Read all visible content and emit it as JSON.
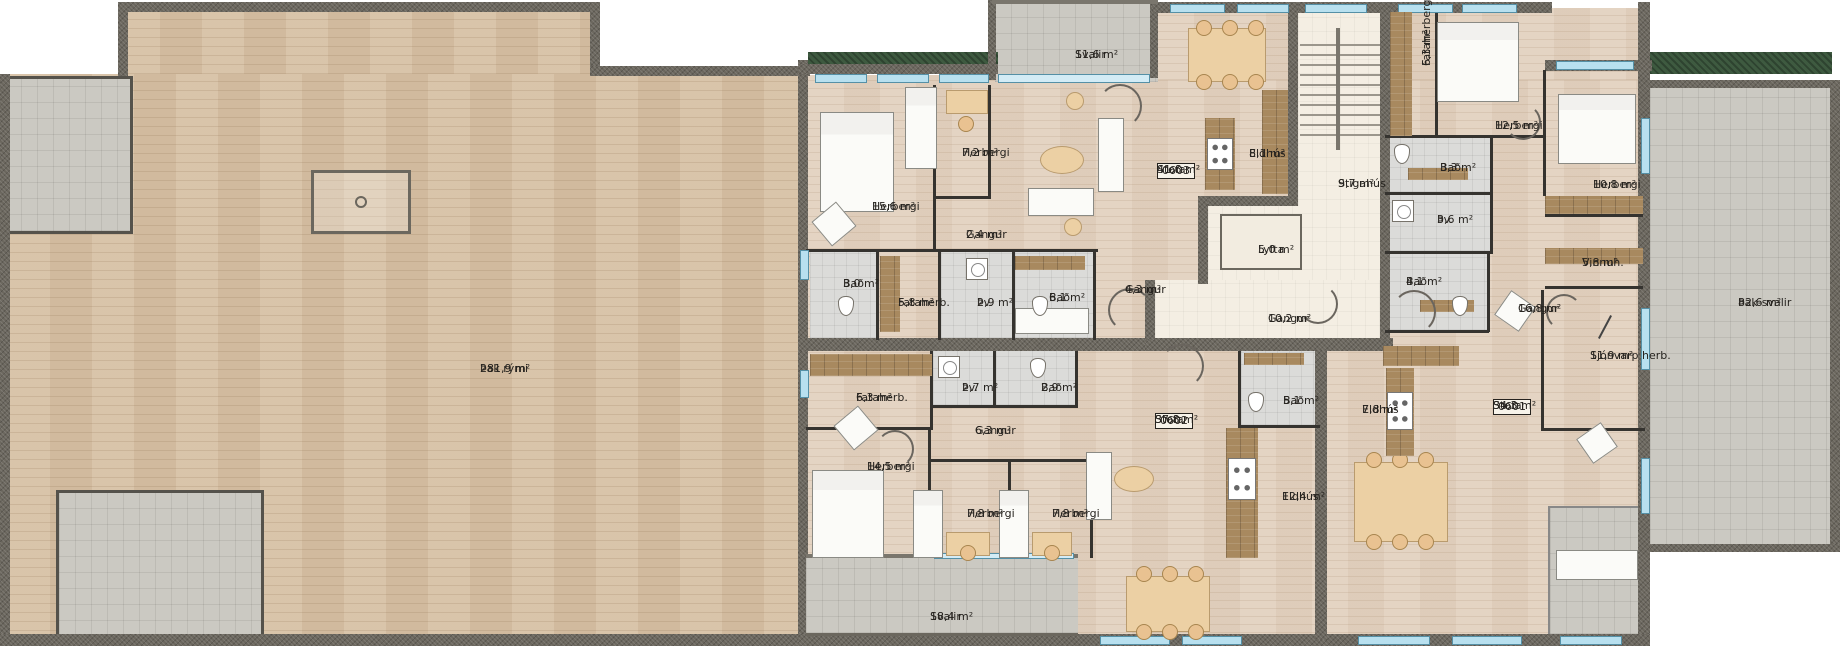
{
  "palette": {
    "wall": "#6b675e",
    "wood-attic": "#d7c1a5",
    "wood-apt": "#e3d2c0",
    "tile-bath": "#dbdbd9",
    "tile-balcony": "#cbc9c2",
    "cream": "#f4eee3",
    "green-roof": "#3e5a40",
    "window-blue": "#b8e0ef",
    "label-ink": "#26231f"
  },
  "rooms": {
    "thak_rymi": {
      "name": "Þak rými",
      "area": "281,9 m²"
    },
    "svalir_0603": {
      "name": "Svalir",
      "area": "11,6 m²"
    },
    "herbergi_15_6": {
      "name": "Herbergi",
      "area": "15,6 m²"
    },
    "herbergi_7_2": {
      "name": "Herbergi",
      "area": "7,2 m²"
    },
    "gangur_2_4": {
      "name": "Gangur",
      "area": "2,4 m²"
    },
    "bad_3_0": {
      "name": "Bað",
      "area": "3,0 m²"
    },
    "fataherb_5_8": {
      "name": "Fataherb.",
      "area": "5,8 m²"
    },
    "thv_2_9": {
      "name": "Þv.",
      "area": "2,9 m²"
    },
    "bad_6_1": {
      "name": "Bað",
      "area": "6,1 m²"
    },
    "gangur_4_3": {
      "name": "Gangur",
      "area": "4,3 m²"
    },
    "stofa_0603": {
      "badge": "0603",
      "name": "Stofa",
      "area": "41,6 m²"
    },
    "eldhus_8_1": {
      "name": "Eldhús",
      "area": "8,1 m²"
    },
    "stigahus": {
      "name": "Stigahús",
      "area": "9,7 m²"
    },
    "lyfta": {
      "name": "Lyfta",
      "area": "5,0 m²"
    },
    "gangur_10_2": {
      "name": "Gangur",
      "area": "10,2 m²"
    },
    "fataherbergi_6_3": {
      "name": "Fataherbergi",
      "area": "6,3 m²"
    },
    "herbergi_12_5": {
      "name": "Herbergi",
      "area": "12,5 m²"
    },
    "bad_3_3": {
      "name": "Bað",
      "area": "3,3 m²"
    },
    "thv_3_6": {
      "name": "Þv.",
      "area": "3,6 m²"
    },
    "bad_4_1": {
      "name": "Bað",
      "area": "4,1 m²"
    },
    "herbergi_10_8": {
      "name": "Herbergi",
      "area": "10,8 m²"
    },
    "vinnuh_5_8": {
      "name": "Vinnuh.",
      "area": "5,8 m²"
    },
    "gangur_16_8": {
      "name": "Gangur",
      "area": "16,8 m²"
    },
    "sjonvarp_herb": {
      "name": "Sjónvarp herb.",
      "area": "11,9 m²"
    },
    "stofa_0601": {
      "badge": "0601",
      "name": "Stofa",
      "area": "34,3 m²"
    },
    "eldhus_7_8": {
      "name": "Eldhús",
      "area": "7,8 m²"
    },
    "bad_5_1": {
      "name": "Bað",
      "area": "5,1 m²"
    },
    "thak_svalir": {
      "name": "Þak-svalir",
      "area": "82,6 m²"
    },
    "fataherb_6_3": {
      "name": "Fataherb.",
      "area": "6,3 m²"
    },
    "thv_2_7": {
      "name": "Þv.",
      "area": "2,7 m²"
    },
    "bad_2_9": {
      "name": "Bað",
      "area": "2,9 m²"
    },
    "gangur_6_3": {
      "name": "Gangur",
      "area": "6,3 m²"
    },
    "herbergi_14_5": {
      "name": "Herbergi",
      "area": "14,5 m²"
    },
    "herbergi_7_8_a": {
      "name": "Herbergi",
      "area": "7,8 m²"
    },
    "herbergi_7_8_b": {
      "name": "Herbergi",
      "area": "7,8 m²"
    },
    "stofa_0602": {
      "badge": "0602",
      "name": "Stofa",
      "area": "37,8 m²"
    },
    "eldhus_12_4": {
      "name": "Eldhús",
      "area": "12,4 m²"
    },
    "svalir_0602": {
      "name": "Svalir",
      "area": "18,4 m²"
    }
  }
}
